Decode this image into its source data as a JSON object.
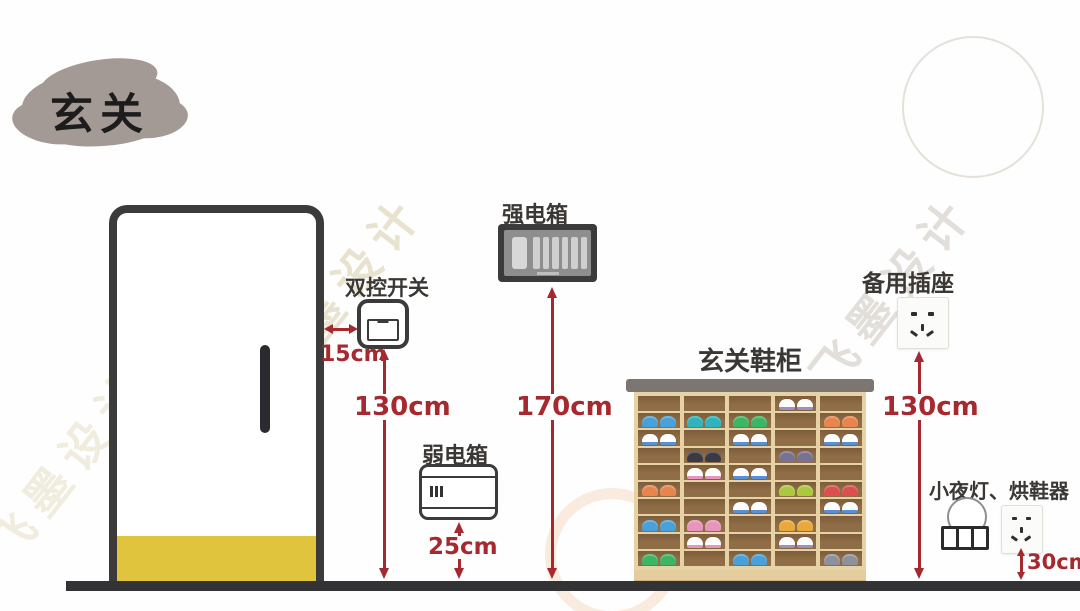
{
  "title": "玄关",
  "watermark": {
    "text": "飞墨设计"
  },
  "colors": {
    "dimension_red": "#a5292e",
    "outline_dark": "#3b3b3b",
    "door_mat_yellow": "#e0c43e",
    "floor_dark": "#333336",
    "title_blob_gray": "#a39a96",
    "cabinet_frame_tan": "#e6d2a4",
    "cabinet_cell_brown": "#8f6d46",
    "cabinet_top_gray": "#7b7671"
  },
  "icons": {
    "switch": "rocker-switch-icon",
    "strong_box": "breaker-panel-icon",
    "weak_box": "media-panel-icon",
    "spare_socket": "cn-5hole-socket-icon",
    "night_socket": "cn-5hole-socket-icon",
    "night_light": "light-bulb-icon"
  },
  "annotations": {
    "switch": {
      "label": "双控开关",
      "offset": "15cm",
      "height": "130cm"
    },
    "strong_box": {
      "label": "强电箱",
      "height": "170cm"
    },
    "weak_box": {
      "label": "弱电箱",
      "height": "25cm"
    },
    "cabinet": {
      "label": "玄关鞋柜"
    },
    "spare_socket": {
      "label": "备用插座",
      "height": "130cm"
    },
    "night_area": {
      "label": "小夜灯、烘鞋器",
      "height": "30cm"
    }
  },
  "cabinet": {
    "rows": 10,
    "cols": 5,
    "shoes": [
      {
        "r": 1,
        "c": 4,
        "trim": "#9d8fc0"
      },
      {
        "r": 2,
        "c": 1,
        "fill": "#4aa0d8"
      },
      {
        "r": 2,
        "c": 2,
        "fill": "#2fb3bd"
      },
      {
        "r": 2,
        "c": 3,
        "fill": "#3eb564"
      },
      {
        "r": 2,
        "c": 5,
        "fill": "#e8854e"
      },
      {
        "r": 3,
        "c": 1,
        "trim": "#5b8fd4"
      },
      {
        "r": 3,
        "c": 3,
        "trim": "#5b8fd4"
      },
      {
        "r": 3,
        "c": 5,
        "trim": "#5b8fd4"
      },
      {
        "r": 4,
        "c": 2,
        "fill": "#3a3a44"
      },
      {
        "r": 4,
        "c": 4,
        "fill": "#787393"
      },
      {
        "r": 5,
        "c": 2,
        "trim": "#e795bd"
      },
      {
        "r": 5,
        "c": 3,
        "trim": "#5b8fd4"
      },
      {
        "r": 6,
        "c": 1,
        "fill": "#e8854e"
      },
      {
        "r": 6,
        "c": 4,
        "fill": "#abc83f"
      },
      {
        "r": 6,
        "c": 5,
        "fill": "#dd4f4f"
      },
      {
        "r": 7,
        "c": 3,
        "trim": "#5b8fd4"
      },
      {
        "r": 7,
        "c": 5,
        "trim": "#5b8fd4"
      },
      {
        "r": 8,
        "c": 1,
        "fill": "#4aa0d8"
      },
      {
        "r": 8,
        "c": 2,
        "fill": "#e795bd"
      },
      {
        "r": 8,
        "c": 4,
        "fill": "#e9a83b"
      },
      {
        "r": 9,
        "c": 2,
        "trim": "#e795bd"
      },
      {
        "r": 9,
        "c": 4,
        "trim": "#9d8fc0"
      },
      {
        "r": 10,
        "c": 1,
        "fill": "#3eb564"
      },
      {
        "r": 10,
        "c": 3,
        "fill": "#4aa0d8"
      },
      {
        "r": 10,
        "c": 5,
        "fill": "#90909c"
      }
    ]
  }
}
